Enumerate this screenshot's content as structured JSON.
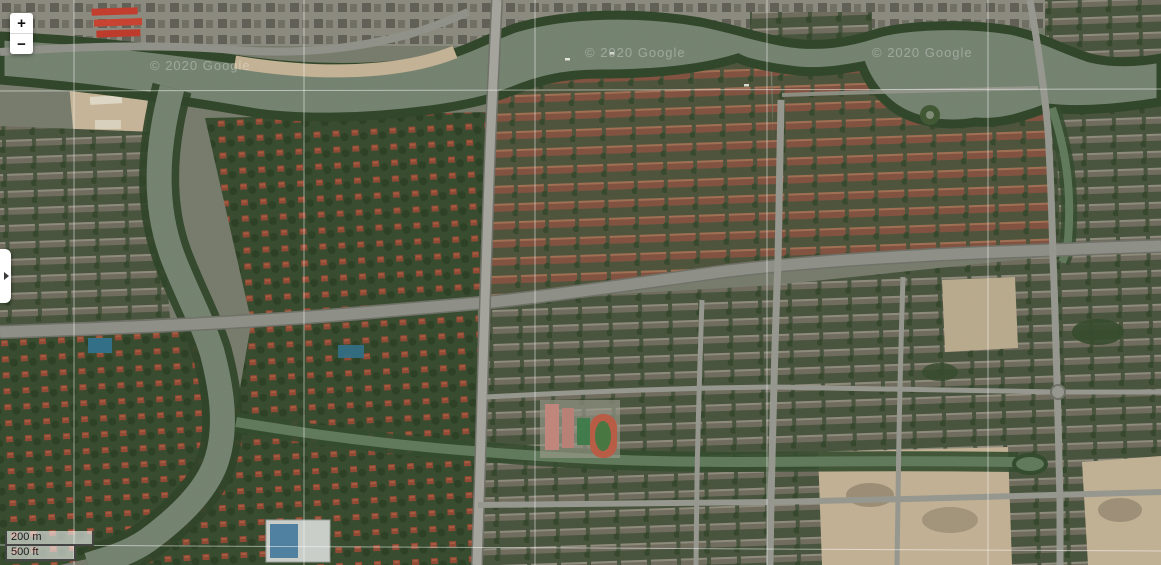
{
  "app": {
    "name": "satellite-map-viewer"
  },
  "map": {
    "imagery_type": "satellite",
    "watermarks": [
      {
        "text": "© 2020 Google"
      },
      {
        "text": "© 2020 Google"
      },
      {
        "text": "© 2020 Google"
      }
    ],
    "colors": {
      "water": "#73816f",
      "canal_water": "#5f7859",
      "vegetation_dark": "#2e4427",
      "villa_roof_red": "#8f4732",
      "apartment_roof_brown": "#81503e",
      "construction_tan": "#c6b497",
      "road_gray": "#9a9a91",
      "gridline_white": "rgba(255,255,255,0.5)",
      "track_red": "#b85a43",
      "track_field_green": "#46753f"
    }
  },
  "controls": {
    "zoom": {
      "zoom_in_label": "+",
      "zoom_out_label": "−"
    },
    "sidebar_toggle": {
      "icon": "chevron-right-icon"
    },
    "scale_bar": {
      "metric_label": "200 m",
      "imperial_label": "500 ft"
    }
  }
}
